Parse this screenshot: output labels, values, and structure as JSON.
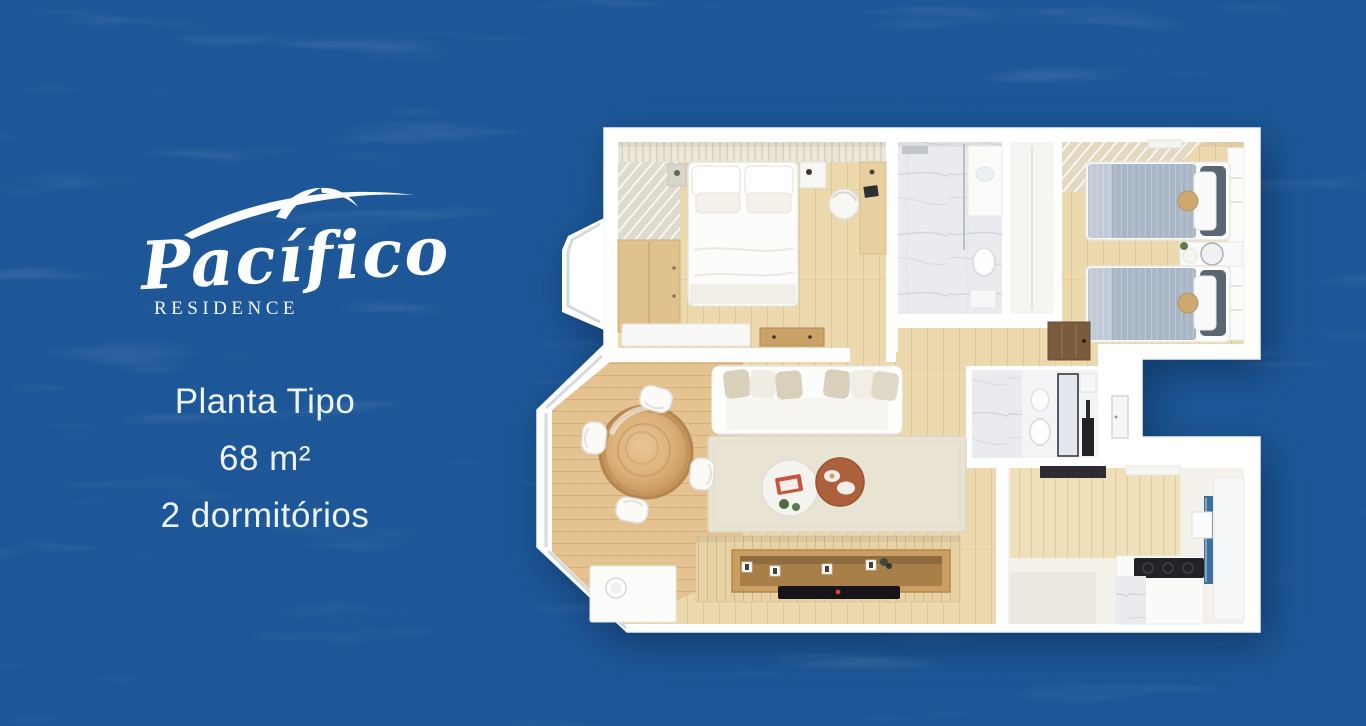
{
  "brand": {
    "name": "Pacífico",
    "subtitle": "RESIDENCE"
  },
  "plan": {
    "title": "Planta Tipo",
    "area": "68 m²",
    "bedrooms": "2 dormitórios"
  },
  "floorplan": {
    "type": "apartment-floor-plan",
    "description": "Top-down 3D render of a two-bedroom apartment",
    "rooms": [
      "master-bedroom",
      "bathroom-1",
      "hallway",
      "bedroom-2",
      "bathroom-2",
      "kitchen",
      "living-dining-room",
      "bay-window-corner"
    ],
    "furniture": [
      "double bed with pillows",
      "louvered wardrobe and dresser",
      "tub chair and desk",
      "white credenza and drawer chest",
      "two twin beds with gray-blue duvets",
      "vanity with round mirror",
      "shower and toilet",
      "kitchen counter with black cooktop",
      "fridge cabinet with blue glass",
      "white sofa with beige cushions",
      "round wooden dining table with four white chairs",
      "white and terracotta coffee tables",
      "wood media wall with TV console and flat TV",
      "beige area rug"
    ]
  },
  "icons": {
    "seagull-swoosh": "stylized seagull flourish above brand name"
  },
  "colors": {
    "background_blue": "#1d5797",
    "wave_highlight": "#2a69ae",
    "logo_white": "#fcfdff",
    "text_white": "#ecf3fb",
    "wall_white": "#ffffff",
    "floor_wood": "#edd9ae",
    "dining_wood": "#e4c28f",
    "duvet_gray_blue": "#a8b6c6",
    "terracotta_table": "#ad603c",
    "tv_black": "#141419",
    "marble_gray": "#e9ebee"
  }
}
